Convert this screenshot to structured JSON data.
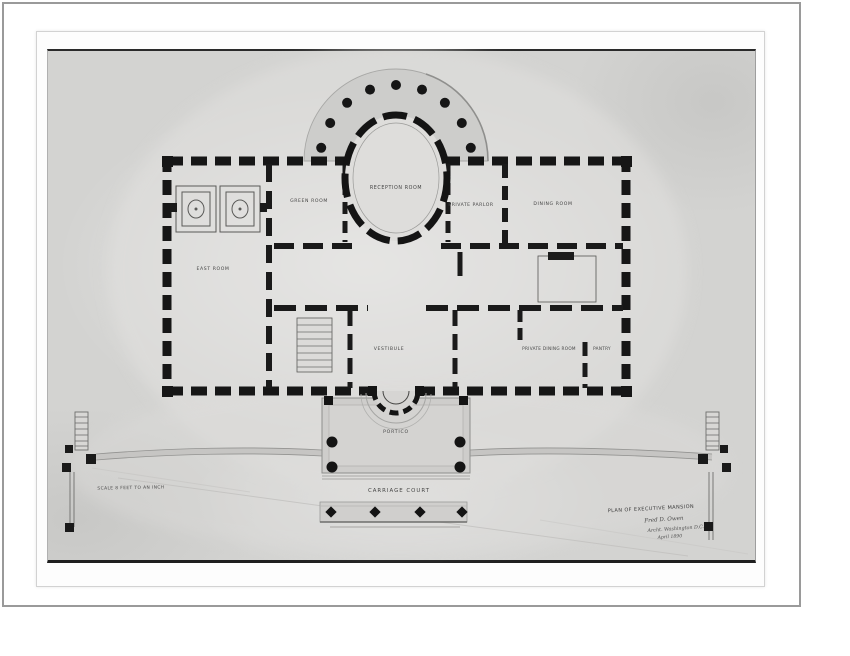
{
  "labels": {
    "reception_room": "RECEPTION ROOM",
    "green_room": "GREEN ROOM",
    "private_parlor": "PRIVATE PARLOR",
    "dining_room": "DINING ROOM",
    "east_room": "EAST ROOM",
    "vestibule": "VESTIBULE",
    "private_dining_room": "PRIVATE DINING ROOM",
    "pantry": "PANTRY",
    "portico": "PORTICO",
    "carriage_court": "CARRIAGE COURT",
    "scale_note": "SCALE 8 FEET TO AN INCH",
    "title": "PLAN OF EXECUTIVE MANSION",
    "signature_line1": "Fred D. Owen",
    "signature_line2": "Archt. Washington D.C.",
    "signature_line3": "April 1890"
  },
  "colors": {
    "page_background": "#ffffff",
    "frame_border": "#9a9a9a",
    "photo_gray": "#d3d3d1",
    "paper_light": "#e0dfdd",
    "terrace_gray": "#cdcdcb",
    "ink_black": "#141414",
    "label_gray": "#454545"
  }
}
